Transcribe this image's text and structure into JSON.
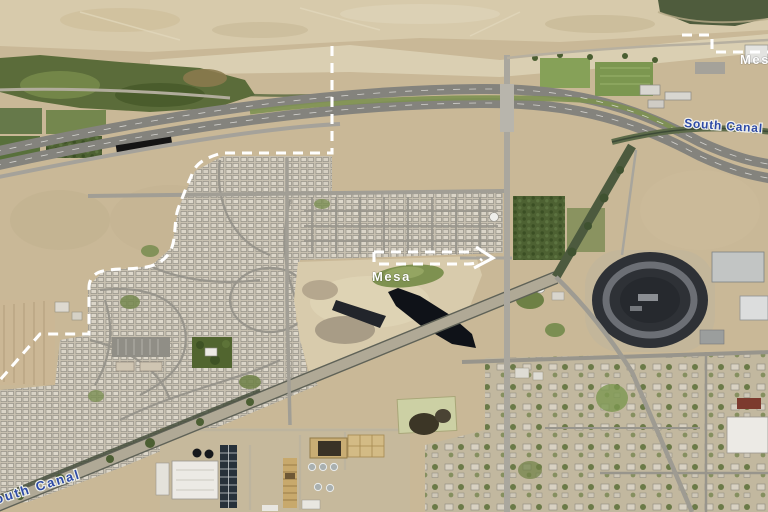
{
  "map": {
    "view_title": "Aerial satellite map with city boundary",
    "place_labels": [
      {
        "id": "mesa-boundary-center",
        "text": "Mesa",
        "color": "#ffffff"
      },
      {
        "id": "mesa-boundary-top-right",
        "text": "Mesa",
        "color": "#ffffff"
      },
      {
        "id": "south-canal-right",
        "text": "South Canal",
        "color": "#2e4ba6"
      },
      {
        "id": "south-canal-bottom-left",
        "text": "South Canal",
        "color": "#2e4ba6"
      }
    ],
    "boundary": {
      "style": "dashed",
      "color": "#ffffff"
    },
    "colors": {
      "desert": "#c9b897",
      "desert_light": "#dbd1b5",
      "river_vegetation": "#5b6c3a",
      "field_green": "#7f9a54",
      "road_gray": "#a7a49b",
      "freeway_gray": "#84837d",
      "race_track_dark": "#2e3136",
      "asphalt_pile_black": "#0f1218",
      "canal_label_blue": "#2e4ba6",
      "boundary_white": "#ffffff"
    }
  }
}
